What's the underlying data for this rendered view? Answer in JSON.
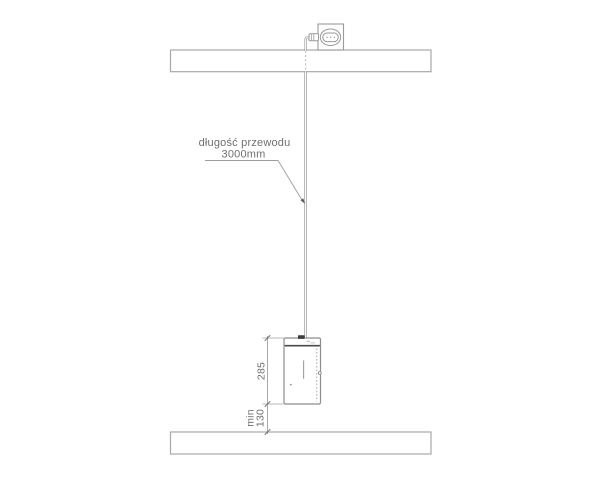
{
  "drawing": {
    "cable_label": {
      "line1": "długość przewodu",
      "line2": "3000mm"
    },
    "dimensions": {
      "lamp_height": "285",
      "clearance_word": "min",
      "clearance_value": "130"
    },
    "colors": {
      "line_grey": "#9a9a9a",
      "beam_grey": "#a8a8a8",
      "cable_grey": "#8f8f8f",
      "dark_accent": "#3c3c3c",
      "text_grey": "#6f6f6f",
      "background": "#ffffff"
    }
  }
}
